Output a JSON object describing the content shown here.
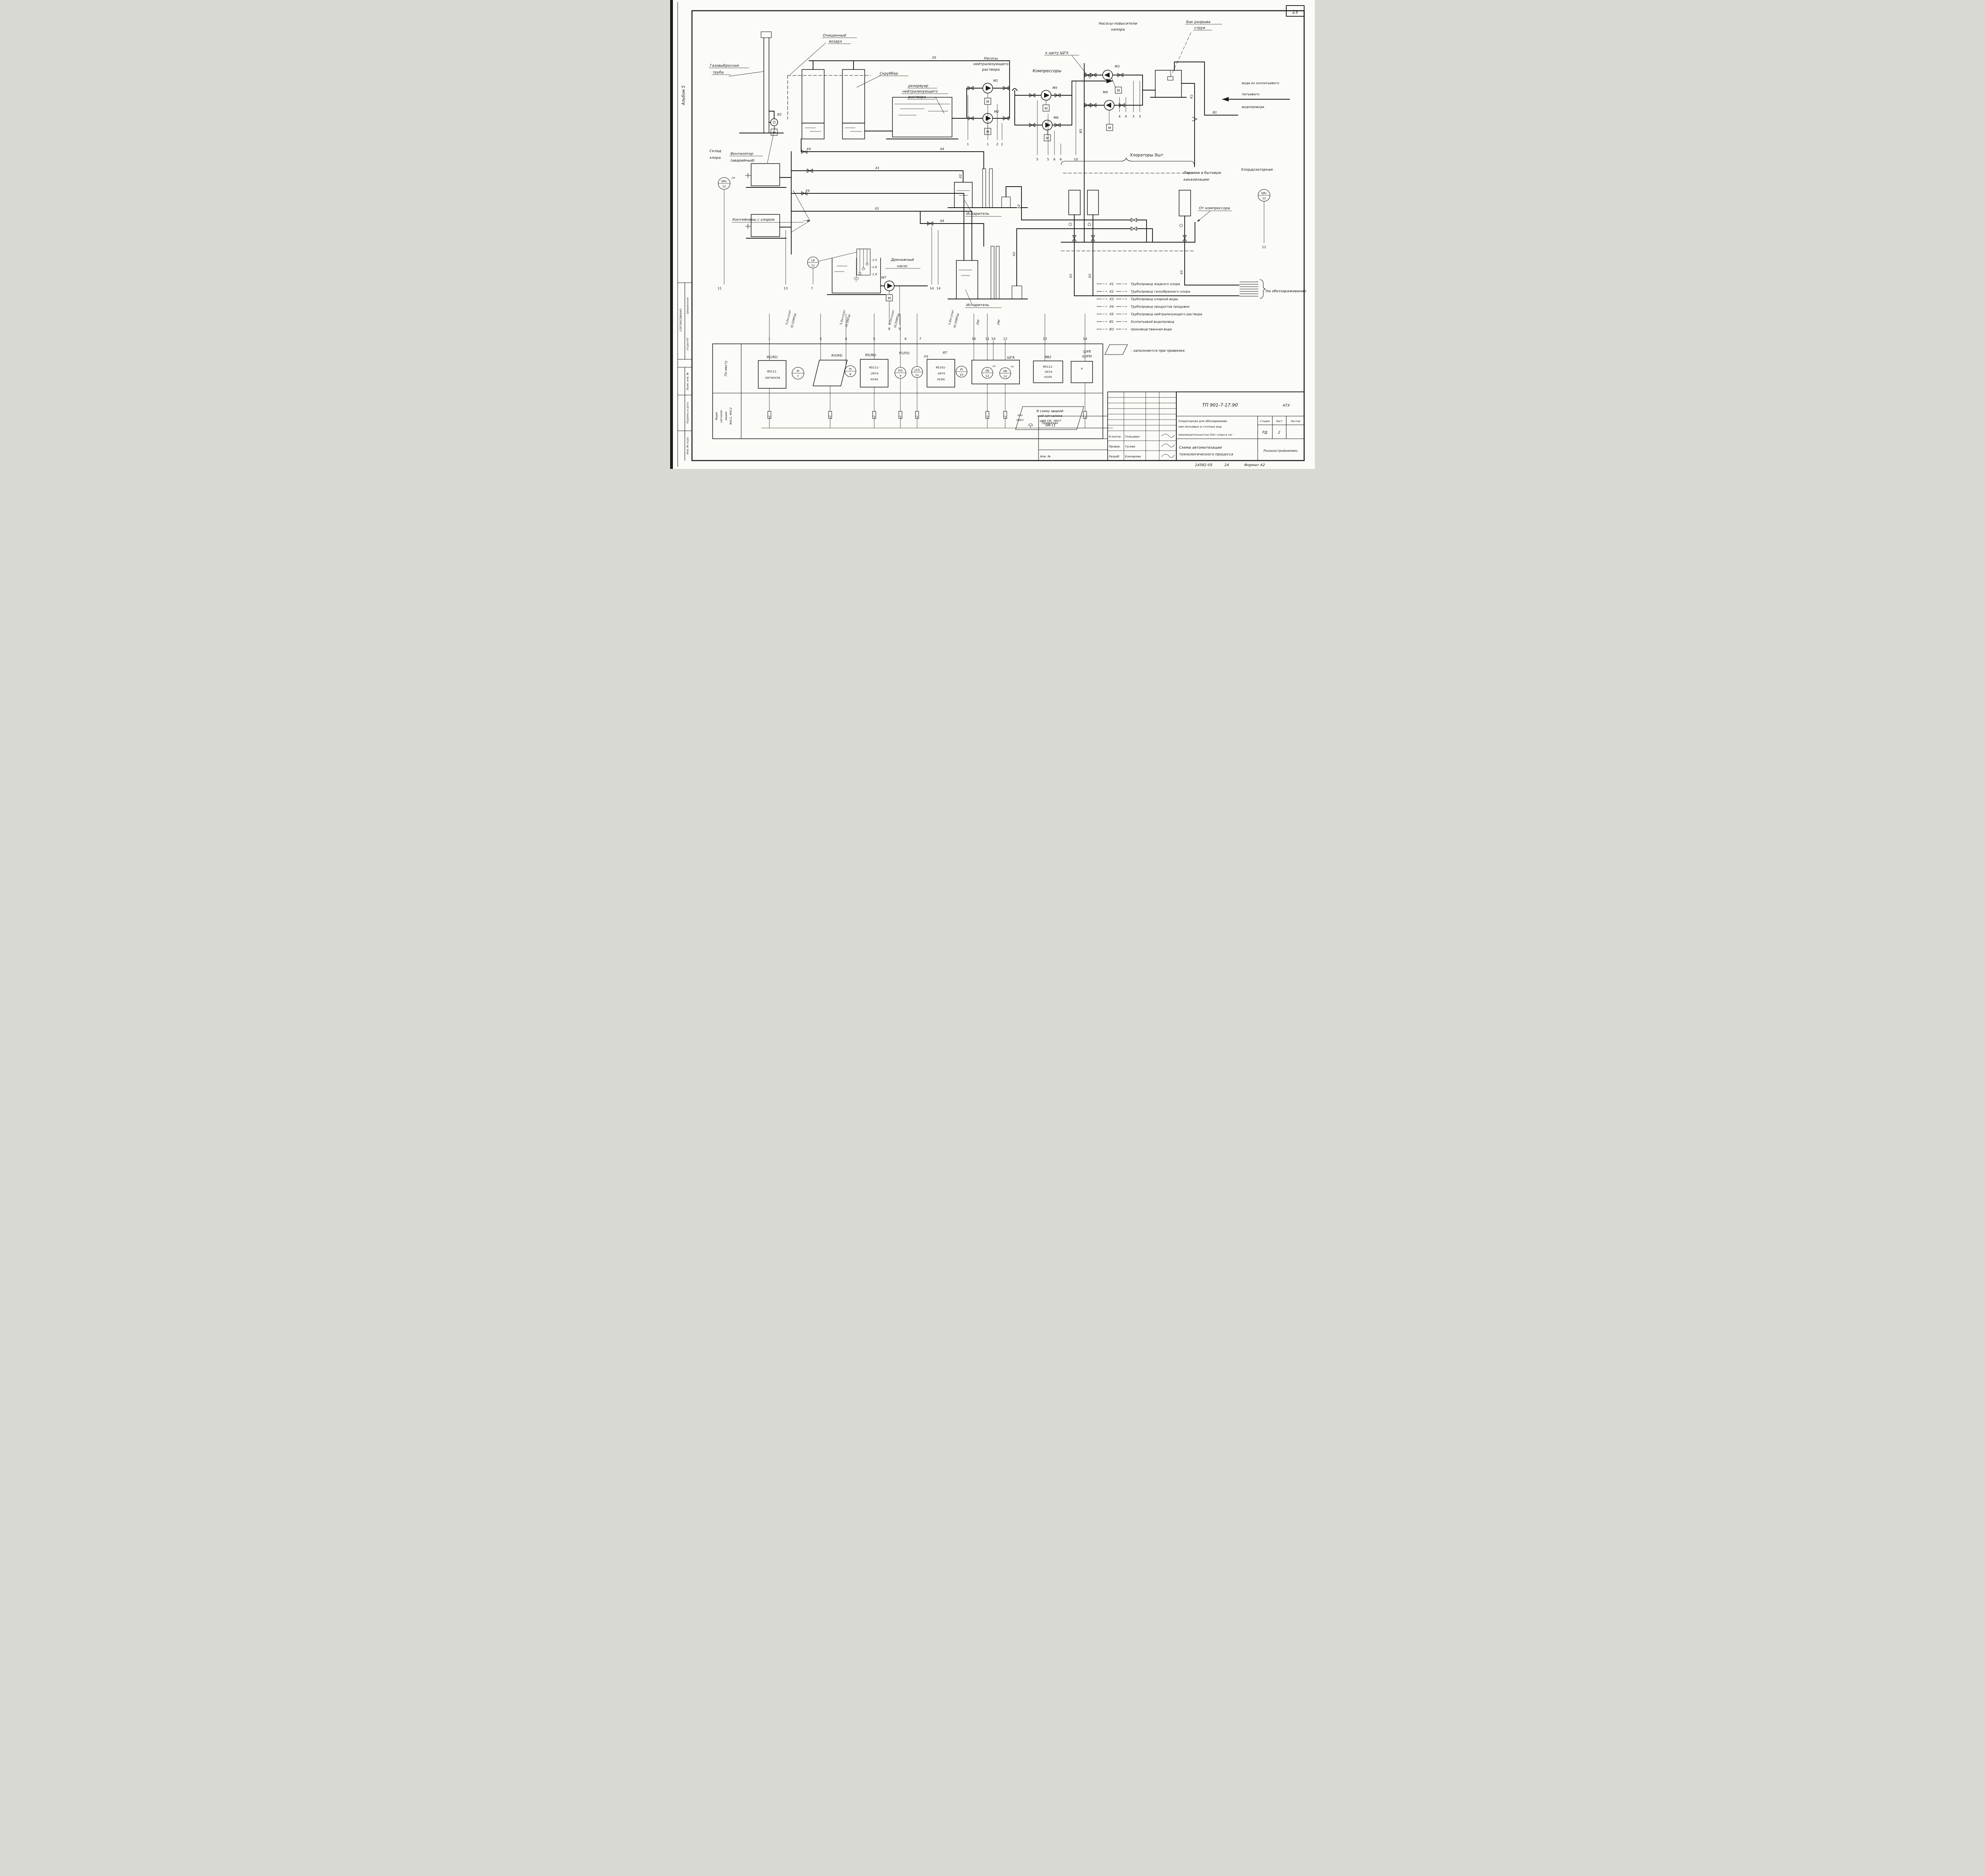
{
  "page": {
    "sheet_number": "23"
  },
  "sidebar": {
    "album": "Альбом 5",
    "agreed": "СОГЛАСОВАНО:",
    "signature": "Шишинская",
    "dept": "Отдел КГ",
    "stamp_vzam": "Взам. инв. №",
    "stamp_sign_date": "Подпись и дата",
    "stamp_inv": "Инв. № подл."
  },
  "labels": {
    "gas_stack_1": "Газовыбросная",
    "gas_stack_2": "труба",
    "clean_air_1": "Очищенный",
    "clean_air_2": "воздух",
    "scrubber": "Скруббер",
    "reservoir_1": "резервуар",
    "reservoir_2": "нейтрализующего",
    "reservoir_3": "раствора",
    "neutral_pumps_1": "Насосы",
    "neutral_pumps_2": "нейтрализующего",
    "neutral_pumps_3": "раствора",
    "to_panel": "к щиту ЩГА",
    "compressors": "Компрессоры",
    "booster_1": "Насосы-повысители",
    "booster_2": "напора",
    "break_tank_1": "Бак разрыва",
    "break_tank_2": "струи",
    "water_in_1": "вода из хозпитьевого",
    "water_in_2": "питьевого",
    "water_in_3": "водопровода",
    "overflow_1": "Перелив в бытовую",
    "overflow_2": "канализацию",
    "chlorators": "Хлораторы 9шт",
    "chlor_room": "Хлордозаторная",
    "from_compressor": "От компрессора",
    "to_disinfection": "На обеззараживание",
    "storage_1": "Склад",
    "storage_2": "хлора",
    "fan_1": "Вентилятор",
    "fan_2": "(аварийный)",
    "containers": "Контейнеры с хлором",
    "evaporator": "Испаритель",
    "drain_pump_1": "Дренажный",
    "drain_pump_2": "насос"
  },
  "pipes": {
    "x1": "Х1",
    "x2": "Х2",
    "x3": "Х3",
    "x4": "Х4",
    "x5": "Х5",
    "b1": "В1",
    "b3": "В3",
    "k1": "К1"
  },
  "tags": {
    "m1": "М1",
    "m2": "М2",
    "m3": "М3",
    "m4": "М4",
    "m5": "М5",
    "m6": "М6",
    "m7": "М7",
    "motor": "М",
    "fan": "В2",
    "star": "*"
  },
  "bubbles": {
    "qrc_store": {
      "tag": "QRc",
      "num": "12",
      "sup": "ce"
    },
    "qrc_room": {
      "tag": "QRc",
      "num": "12"
    },
    "le": {
      "tag": "LE",
      "num": "11"
    },
    "pi7": {
      "tag": "PI",
      "num": "7"
    },
    "pi8": {
      "tag": "PI",
      "num": "8"
    },
    "pis9": {
      "tag": "PIS",
      "num": "9"
    },
    "lcs11": {
      "tag": "LCS",
      "num": "11"
    },
    "pi10": {
      "tag": "PI",
      "num": "10"
    },
    "qe12a": {
      "tag": "QE",
      "num": "12",
      "sup": "ce"
    },
    "qe12b": {
      "tag": "QE",
      "num": "12",
      "sup": "ce"
    }
  },
  "levels": {
    "l1": "-1,5",
    "l2": "-1,6",
    "l3": "-1,9"
  },
  "pressures": {
    "p32a": "3,2кгс/см²",
    "p32b": "(0,32МПа)",
    "p50a": "5,0кгс/см²",
    "p50b": "(0,5МПа)",
    "p05a": "0,5кгс/см²",
    "p05b": "(0,05МПа)",
    "p16a": "1,6кгс/см²",
    "p16b": "(0,16МПа)",
    "mg": "2МГ"
  },
  "wires": {
    "w1": "1",
    "w2": "2",
    "w3": "3",
    "w4": "4",
    "w5": "5",
    "w6": "6",
    "w7": "7",
    "w8": "8",
    "w9": "9",
    "w10": "10",
    "w11": "11",
    "w12": "12",
    "w13": "13",
    "w14": "14"
  },
  "legend": {
    "items": [
      {
        "code": "Х1",
        "name": "Трубопровод жидкого хлора"
      },
      {
        "code": "Х2",
        "name": "Трубопровод газообразного хлора"
      },
      {
        "code": "Х3",
        "name": "Трубопровод хлорной воды"
      },
      {
        "code": "Х4",
        "name": "Трубопровод продуктов продувки"
      },
      {
        "code": "Х5",
        "name": "Трубопровод нейтрализующего раствора"
      },
      {
        "code": "В1",
        "name": "Хозпитьевой водопровод"
      },
      {
        "code": "В3",
        "name": "производственная вода"
      }
    ],
    "fill_note": "-  заполняется  при привязке."
  },
  "strip": {
    "row1": "По месту",
    "row2": [
      "Ящик",
      "сигнали-",
      "зации",
      "ЯАС1, ЯАС2"
    ],
    "i1_tag": "Я1(Я2)",
    "i1_1": "Я5111-",
    "i1_2": "-3974УХЛ4",
    "i3_tag": "Я3(Я4)",
    "i5_tag": "Я5(Я6)",
    "i5_1": "Я5111-",
    "i5_2": "-2874",
    "i5_3": "УХЛ4",
    "p12_tag": "Р1(Р2)",
    "p3_tag": "Р3",
    "i7_tag": "Я7",
    "i7_1": "Я5141-",
    "i7_2": "-2674",
    "i7_3": "УХЛ4",
    "shga": "ЩГА",
    "yav2_tag": "ЯВ2",
    "yav2_1": "Я5111-",
    "yav2_2": "-3574",
    "yav2_3": "УХЛ4",
    "shu_1": "ШУ8",
    "shu_2": "(ШУ9)",
    "note": [
      "В схему аварий-",
      "ной сигнализа-",
      "ции см. лист",
      "ЭМ-11"
    ],
    "note_tag1": "НА1",
    "note_tag2": "(НА2)"
  },
  "titleblock": {
    "doc": "ТП 901-7-17.90",
    "code_right": "АТХ",
    "title": [
      "Хлораторная для обеззаражива-",
      "ния питьевых и сточных вод",
      "производительностью 50кг хлора в час"
    ],
    "stage_label": "Стадия",
    "sheet_label": "Лист",
    "sheets_label": "Листов",
    "stage": "РД",
    "sheet": "2",
    "scheme": [
      "Схема автоматизации",
      "технологического процесса"
    ],
    "org": "Росиннстройнмпекс",
    "attach": "Привязан",
    "inv": "Инв. №",
    "row1_role": "Н.контр.",
    "row1_name": "Гольцман",
    "row2_role": "Провер.",
    "row2_name": "Гусева",
    "row3_role": "Разраб.",
    "row3_name": "Елизарова",
    "footer_code": "24582-05",
    "footer_page": "24",
    "footer_format": "Формат А2"
  }
}
